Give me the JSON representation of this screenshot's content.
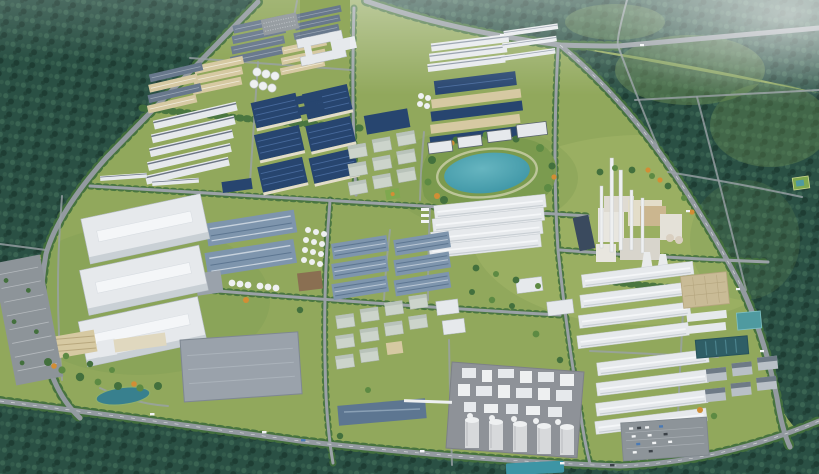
{
  "scene": {
    "type": "aerial-3d-architectural-render",
    "subject": "Bird's-eye rendering of an industrial park master plan surrounded by forest",
    "regions": [
      "forest-belt-northwest",
      "forest-belt-north",
      "forest-belt-east",
      "forest-belt-south",
      "navy-solar-roof-warehouse-block",
      "steel-blue-workshop-block",
      "white-logistics-halls",
      "office-and-dormitory-campus",
      "lakeside-park-with-lake",
      "power-plant-with-chimneys",
      "chemical-plant-with-silos",
      "long-white-warehouse-rows",
      "storage-tank-clusters",
      "water-treatment-basins",
      "retention-pond",
      "parking-lots",
      "tree-lined-boulevards",
      "perimeter-ring-road",
      "forest-trail-roads",
      "meadow-clearings"
    ]
  },
  "colors": {
    "grass": "#91a85c",
    "grass_light": "#a3b468",
    "grass_dark": "#79994e",
    "forest_base": "#2a5044",
    "forest_light": "#3a6452",
    "forest_dark": "#1e3d33",
    "forest_olive": "#6f9154",
    "road": "#939aa0",
    "road_minor": "#9aa1a6",
    "road_marking": "#e8eaec",
    "tree_line": "#43703d",
    "tree_light": "#5d8a43",
    "tree_accent": "#d28e35",
    "roof_blue_dark": "#27456f",
    "roof_blue_light": "#47699b",
    "roof_steel": "#7e95ad",
    "roof_steel_dark": "#5d7691",
    "roof_slate": "#68788c",
    "roof_white": "#e6e9ec",
    "roof_white_bright": "#f4f6f8",
    "roof_white_shade": "#c2c9cf",
    "wall_tan": "#d6c9a2",
    "wall_cream": "#e3ddc9",
    "building_gray": "#9aa2ab",
    "campus_gray": "#ccd4cb",
    "pad_gray": "#8e9298",
    "parking_gray": "#8d9499",
    "water_lake": "#3d95a5",
    "water_lake_light": "#66b5c0",
    "water_pond": "#38808e",
    "water_basin": "#2f5e66",
    "solar_panel": "#3a4a5e",
    "stack_white": "#eef0f1"
  }
}
